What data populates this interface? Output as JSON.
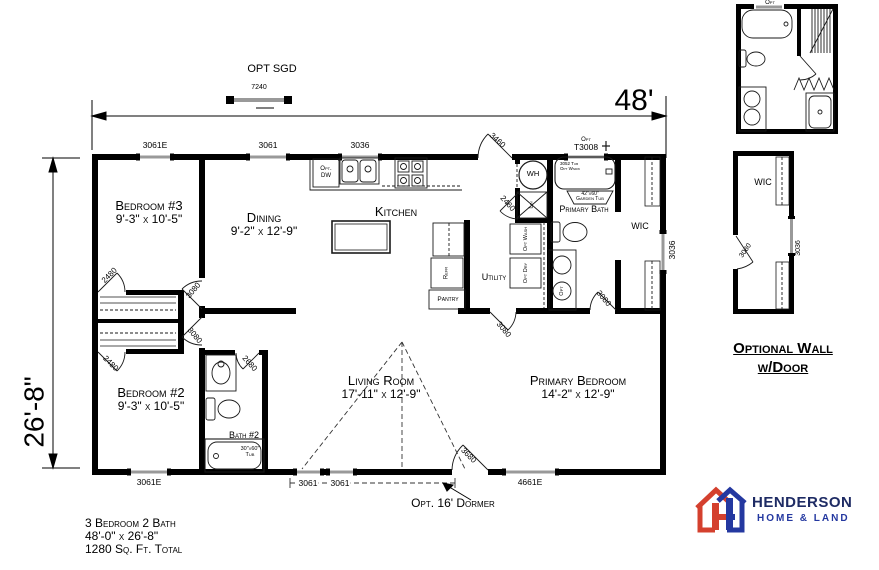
{
  "dimensions": {
    "width": "48'",
    "depth": "26'-8\""
  },
  "annotations": {
    "opt_sgd": "OPT SGD",
    "opt_sgd_size": "7240",
    "dormer": "Opt. 16' Dormer"
  },
  "rooms": {
    "bedroom3": {
      "name": "Bedroom #3",
      "dims": "9'-3\" x 10'-5\""
    },
    "bedroom2": {
      "name": "Bedroom #2",
      "dims": "9'-3\" x 10'-5\""
    },
    "dining": {
      "name": "Dining",
      "dims": "9'-2\" x 12'-9\""
    },
    "kitchen": {
      "name": "Kitchen"
    },
    "living": {
      "name": "Living Room",
      "dims": "17'-11\" x 12'-9\""
    },
    "primary_bedroom": {
      "name": "Primary Bedroom",
      "dims": "14'-2\" x 12'-9\""
    },
    "primary_bath": {
      "name": "Primary Bath"
    },
    "bath2": {
      "name": "Bath #2"
    },
    "wic": {
      "name": "WIC"
    },
    "utility": {
      "name": "Utility"
    },
    "pantry": {
      "name": "Pantry"
    }
  },
  "windows": {
    "top_bedroom3": "3061E",
    "top_dining": "3061",
    "top_kitchen": "3036",
    "top_bath_opt": "Opt",
    "top_bath": "T3008",
    "right_wic": "3036",
    "bottom_bedroom2": "3061E",
    "bottom_living_a": "3061",
    "bottom_living_b": "3061",
    "bottom_primary": "4661E"
  },
  "doors": {
    "back": "3460",
    "bath_hall": "2460",
    "bedroom3": "3080",
    "bedroom3_closet": "2480",
    "bedroom2": "3080",
    "bedroom2_closet": "2480",
    "bath2": "2680",
    "primary_bedroom": "3080",
    "wic": "3080",
    "front": "3680"
  },
  "fixtures": {
    "water_heater": "WH",
    "linen": "Lin",
    "refrigerator": "Refr",
    "dishwasher_l1": "Opt.",
    "dishwasher_l2": "DW",
    "washer": "Opt Wash",
    "dryer": "Opt Dry",
    "vanity_opt": "Opt",
    "garden_tub_size": "42\"x60\"",
    "garden_tub": "Garden Tub",
    "tub_note_l1": "3052 Tub",
    "tub_note_l2": "Opt Wndw",
    "bath2_tub_size": "30\"x60\"",
    "bath2_tub": "Tub"
  },
  "side_panel": {
    "opt_bath_label": "Opt",
    "wic": "WIC",
    "door": "3080",
    "window": "3036",
    "caption_line1": "Optional Wall",
    "caption_line2": "w/Door"
  },
  "title_block": {
    "line1": "3 Bedroom 2 Bath",
    "line2": "48'-0\" x 26'-8\"",
    "line3": "1280 Sq. Ft. Total"
  },
  "logo": {
    "brand": "HENDERSON",
    "tagline": "HOME & LAND"
  },
  "colors": {
    "logo_red": "#d4402e",
    "logo_blue": "#2438a0",
    "logo_navy": "#1e2b64",
    "ink": "#000000"
  }
}
